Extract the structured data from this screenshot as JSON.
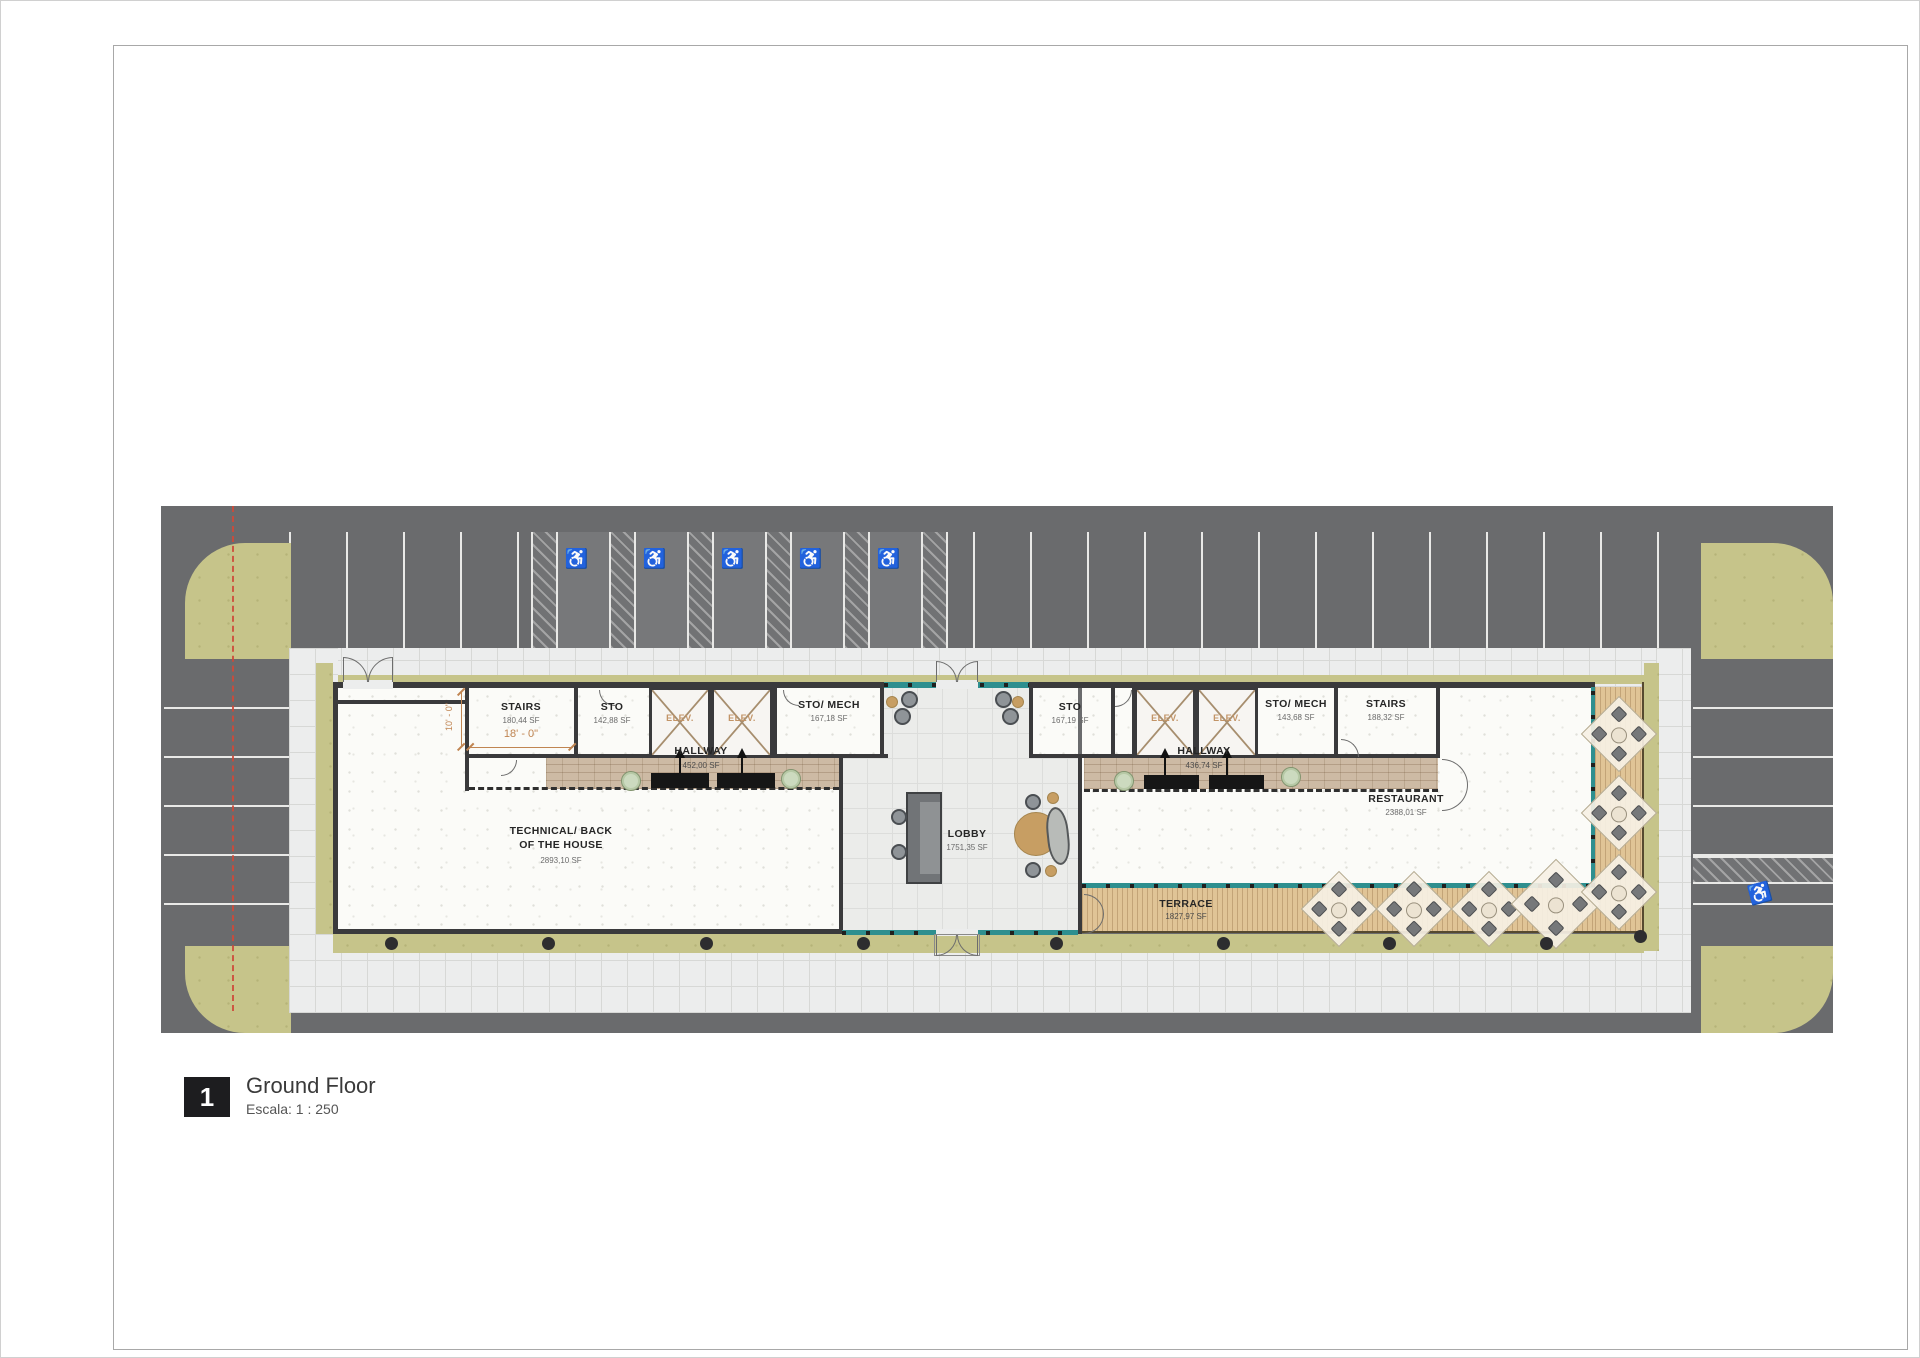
{
  "plan": {
    "parking": {
      "accessible_icon": "♿"
    },
    "rooms": {
      "stairs_left": {
        "label": "STAIRS",
        "area": "180,44 SF",
        "dim_width": "18' - 0\"",
        "dim_depth": "10' - 0\""
      },
      "sto_left": {
        "label": "STO",
        "area": "142,88 SF"
      },
      "elev": {
        "label": "ELEV."
      },
      "sto_mech_left": {
        "label": "STO/ MECH",
        "area": "167,18 SF"
      },
      "hallway_left": {
        "label": "HALLWAY",
        "area": "452,00 SF"
      },
      "technical": {
        "label_line1": "TECHNICAL/ BACK",
        "label_line2": "OF THE HOUSE",
        "area": "2893,10 SF"
      },
      "lobby": {
        "label": "LOBBY",
        "area": "1751,35 SF"
      },
      "sto_right": {
        "label": "STO",
        "area": "167,19 SF"
      },
      "sto_mech_right": {
        "label": "STO/ MECH",
        "area": "143,68 SF"
      },
      "stairs_right": {
        "label": "STAIRS",
        "area": "188,32 SF"
      },
      "hallway_right": {
        "label": "HALLWAY",
        "area": "436,74 SF"
      },
      "restaurant": {
        "label": "RESTAURANT",
        "area": "2388,01 SF"
      },
      "terrace": {
        "label": "TERRACE",
        "area": "1827,97 SF"
      }
    }
  },
  "title_block": {
    "number": "1",
    "view_name": "Ground Floor",
    "scale": "Escala: 1 : 250"
  },
  "palette": {
    "asphalt": "#6a6b6d",
    "landscape_green": "#c6c48a",
    "sidewalk": "#eceded",
    "glass_teal": "#2e8f8f",
    "deck_wood": "#e0c496",
    "hallway_brick": "#cdbaa4",
    "wall": "#3a3a3c",
    "dimension_orange": "#c08552",
    "property_line_red": "#cc4a3a",
    "title_black": "#1d1d1f"
  }
}
